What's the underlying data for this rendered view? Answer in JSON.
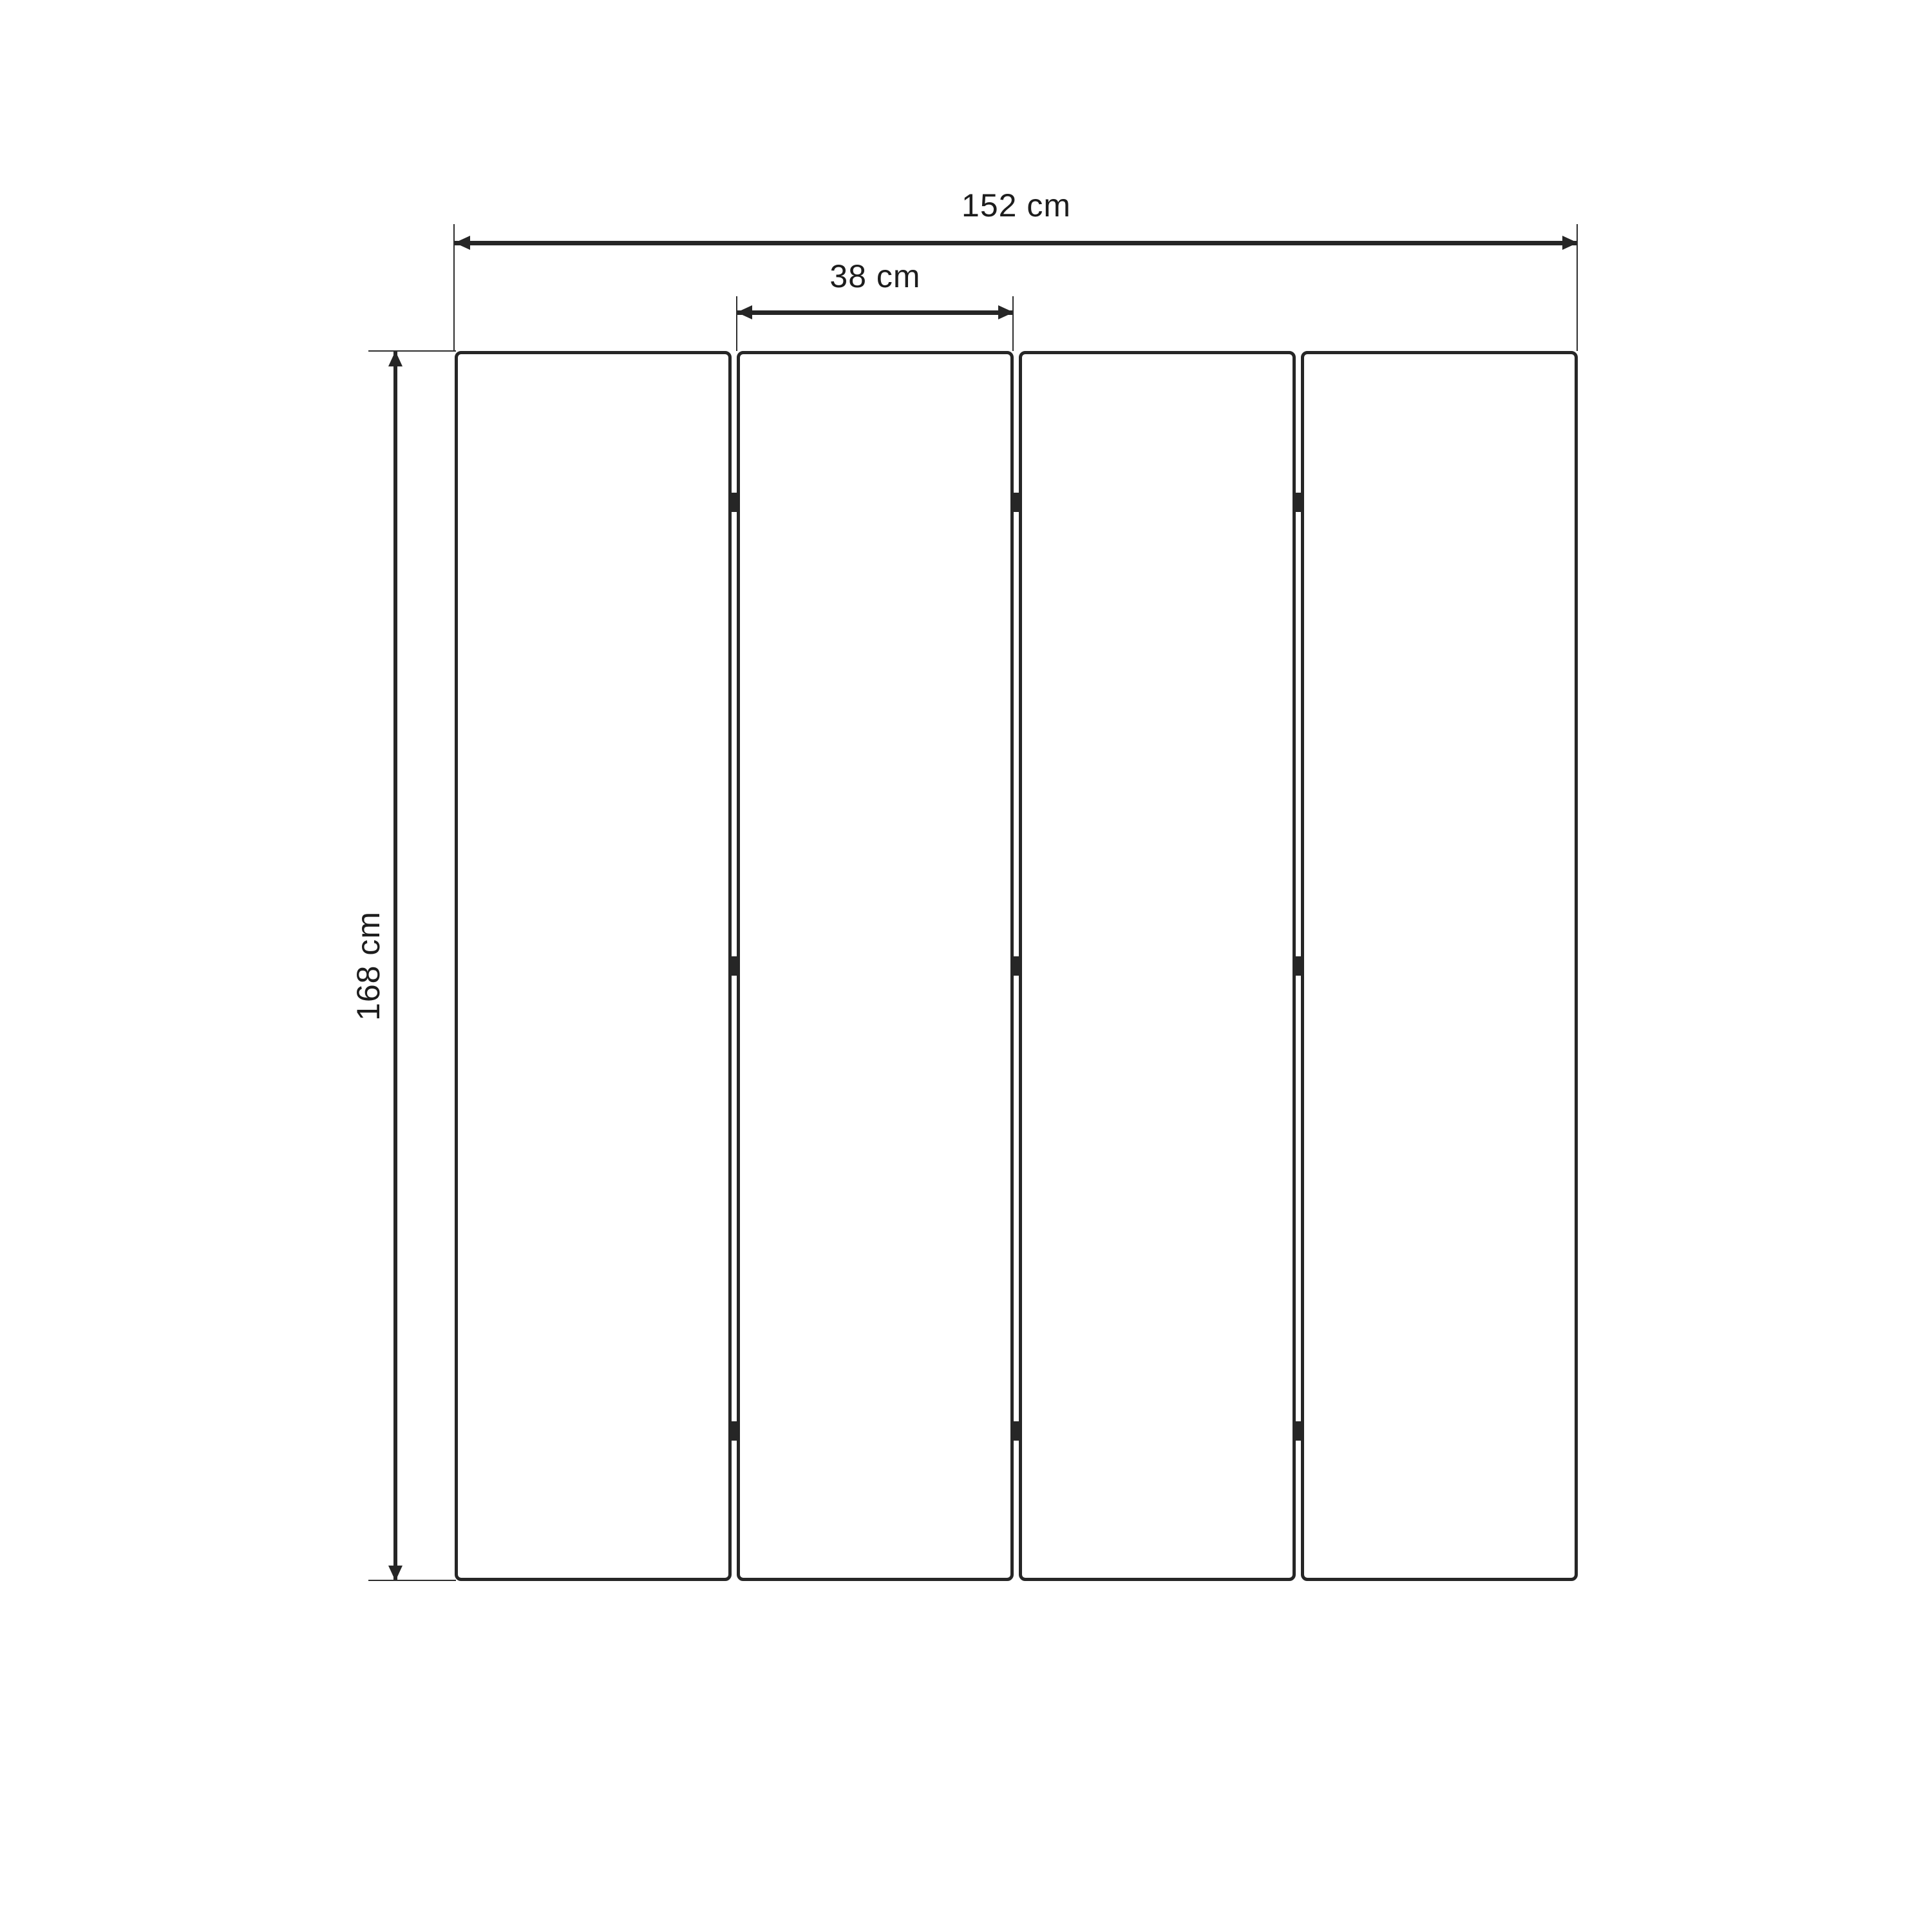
{
  "diagram": {
    "subject": "four-panel folding screen, front elevation with dimensions",
    "labels": {
      "total_width": "152 cm",
      "panel_width": "38 cm",
      "height": "168 cm"
    },
    "panel_count": 4,
    "hinge_count": 9,
    "colors": {
      "line": "#262626",
      "background": "#ffffff",
      "panel_fill": "#ffffff"
    }
  }
}
